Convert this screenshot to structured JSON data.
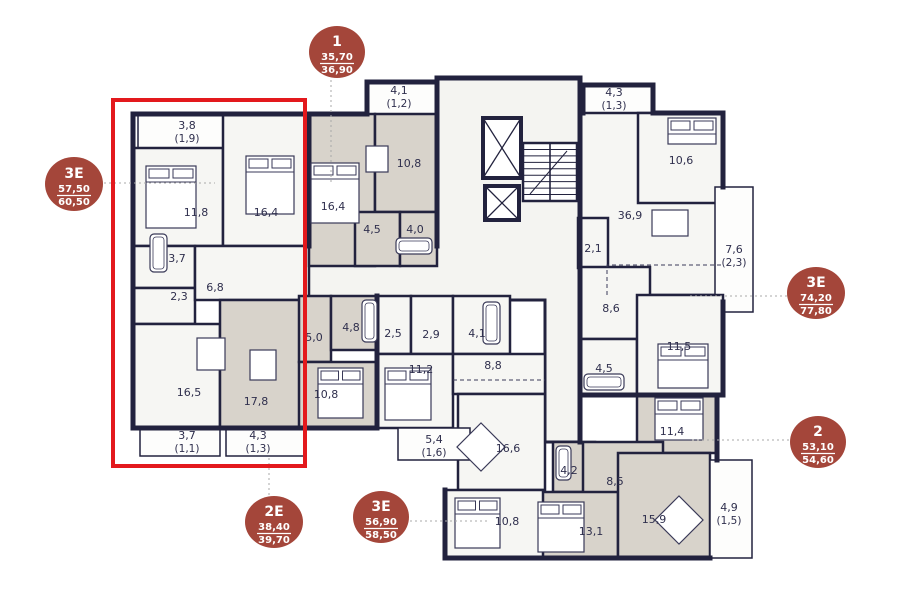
{
  "canvas": {
    "w": 897,
    "h": 616
  },
  "colors": {
    "background": "#ffffff",
    "wall": "#22223e",
    "room_white": "#f6f6f3",
    "room_grey": "#d8d3cb",
    "balcony": "#fdfdfc",
    "corridor": "#f4f4f1",
    "label": "#2f2f4d",
    "badge": "#a4463a",
    "badge_text": "#ffffff",
    "highlight": "#e3191d",
    "leader": "#a9a9a9",
    "furniture": "#3a3a58"
  },
  "badges": [
    {
      "name": "apt-1",
      "label": "1",
      "area": "35,70",
      "total": "36,90",
      "cx": 337,
      "cy": 52,
      "rx": 28,
      "ry": 26,
      "leader": [
        [
          331,
          80
        ],
        [
          331,
          183
        ]
      ]
    },
    {
      "name": "apt-3e-left",
      "label": "3E",
      "area": "57,50",
      "total": "60,50",
      "cx": 74,
      "cy": 184,
      "rx": 29,
      "ry": 27,
      "leader": [
        [
          104,
          183
        ],
        [
          215,
          183
        ]
      ]
    },
    {
      "name": "apt-3e-right",
      "label": "3E",
      "area": "74,20",
      "total": "77,80",
      "cx": 816,
      "cy": 293,
      "rx": 29,
      "ry": 26,
      "leader": [
        [
          690,
          296
        ],
        [
          787,
          296
        ]
      ]
    },
    {
      "name": "apt-2",
      "label": "2",
      "area": "53,10",
      "total": "54,60",
      "cx": 818,
      "cy": 442,
      "rx": 28,
      "ry": 26,
      "leader": [
        [
          692,
          440
        ],
        [
          789,
          440
        ]
      ]
    },
    {
      "name": "apt-2e",
      "label": "2E",
      "area": "38,40",
      "total": "39,70",
      "cx": 274,
      "cy": 522,
      "rx": 29,
      "ry": 26,
      "leader": [
        [
          269,
          458
        ],
        [
          269,
          495
        ]
      ]
    },
    {
      "name": "apt-3e-bottom",
      "label": "3E",
      "area": "56,90",
      "total": "58,50",
      "cx": 381,
      "cy": 517,
      "rx": 28,
      "ry": 26,
      "leader": [
        [
          410,
          521
        ],
        [
          487,
          521
        ]
      ]
    }
  ],
  "highlight": {
    "x": 113,
    "y": 100,
    "w": 192,
    "h": 366
  },
  "corridor": {
    "points": "437,78 580,78 580,442 545,442 545,300 305,300 305,246 437,246"
  },
  "apartments": [
    {
      "name": "apt-3e-left",
      "fill": "white",
      "rooms": [
        {
          "label": "3,8",
          "sub": "(1,9)",
          "x": 138,
          "y": 114,
          "w": 92,
          "h": 34,
          "lx": 187,
          "ly": 125,
          "balcony": true
        },
        {
          "label": "11,8",
          "x": 133,
          "y": 148,
          "w": 90,
          "h": 98,
          "lx": 196,
          "ly": 212
        },
        {
          "label": "16,4",
          "x": 223,
          "y": 114,
          "w": 86,
          "h": 132,
          "lx": 266,
          "ly": 212
        },
        {
          "label": "3,7",
          "x": 133,
          "y": 246,
          "w": 62,
          "h": 42,
          "lx": 177,
          "ly": 258
        },
        {
          "label": "2,3",
          "x": 133,
          "y": 288,
          "w": 62,
          "h": 36,
          "lx": 179,
          "ly": 296
        },
        {
          "label": "6,8",
          "x": 195,
          "y": 246,
          "w": 114,
          "h": 54,
          "lx": 215,
          "ly": 287
        },
        {
          "label": "16,5",
          "x": 133,
          "y": 324,
          "w": 87,
          "h": 104,
          "lx": 189,
          "ly": 392
        },
        {
          "label": "3,7",
          "sub": "(1,1)",
          "x": 140,
          "y": 428,
          "w": 80,
          "h": 28,
          "lx": 187,
          "ly": 435,
          "balcony": true
        }
      ]
    },
    {
      "name": "apt-2e",
      "fill": "grey",
      "rooms": [
        {
          "label": "17,8",
          "x": 220,
          "y": 300,
          "w": 85,
          "h": 128,
          "lx": 256,
          "ly": 401
        },
        {
          "label": "5,0",
          "x": 299,
          "y": 296,
          "w": 32,
          "h": 66,
          "lx": 314,
          "ly": 337
        },
        {
          "label": "4,8",
          "x": 331,
          "y": 296,
          "w": 46,
          "h": 54,
          "lx": 351,
          "ly": 327
        },
        {
          "label": "10,8",
          "x": 299,
          "y": 362,
          "w": 78,
          "h": 66,
          "lx": 326,
          "ly": 394
        },
        {
          "label": "4,3",
          "sub": "(1,3)",
          "x": 226,
          "y": 428,
          "w": 78,
          "h": 28,
          "lx": 258,
          "ly": 435,
          "balcony": true
        }
      ]
    },
    {
      "name": "apt-1",
      "fill": "grey",
      "rooms": [
        {
          "label": "4,1",
          "sub": "(1,2)",
          "x": 367,
          "y": 82,
          "w": 70,
          "h": 32,
          "lx": 399,
          "ly": 90,
          "balcony": true
        },
        {
          "label": "16,4",
          "x": 309,
          "y": 114,
          "w": 66,
          "h": 152,
          "lx": 333,
          "ly": 206
        },
        {
          "label": "10,8",
          "x": 375,
          "y": 114,
          "w": 62,
          "h": 98,
          "lx": 409,
          "ly": 163
        },
        {
          "label": "4,5",
          "x": 355,
          "y": 212,
          "w": 45,
          "h": 54,
          "lx": 372,
          "ly": 229
        },
        {
          "label": "4,0",
          "x": 400,
          "y": 212,
          "w": 37,
          "h": 54,
          "lx": 415,
          "ly": 229
        }
      ]
    },
    {
      "name": "apt-3e-top-right",
      "fill": "white",
      "rooms": [
        {
          "label": "4,3",
          "sub": "(1,3)",
          "x": 583,
          "y": 85,
          "w": 70,
          "h": 28,
          "lx": 614,
          "ly": 92,
          "balcony": true
        },
        {
          "label": "36,9",
          "x": 580,
          "y": 113,
          "w": 143,
          "h": 182,
          "lx": 630,
          "ly": 215
        },
        {
          "label": "10,6",
          "x": 638,
          "y": 113,
          "w": 85,
          "h": 90,
          "lx": 681,
          "ly": 160
        },
        {
          "label": "2,1",
          "x": 578,
          "y": 218,
          "w": 30,
          "h": 50,
          "lx": 593,
          "ly": 248
        },
        {
          "label": "7,6",
          "sub": "(2,3)",
          "x": 715,
          "y": 187,
          "w": 38,
          "h": 125,
          "lx": 734,
          "ly": 249,
          "balcony": true
        },
        {
          "label": "8,6",
          "x": 580,
          "y": 267,
          "w": 70,
          "h": 72,
          "lx": 611,
          "ly": 308
        },
        {
          "label": "4,5",
          "x": 580,
          "y": 339,
          "w": 57,
          "h": 56,
          "lx": 604,
          "ly": 368
        },
        {
          "label": "11,5",
          "x": 637,
          "y": 295,
          "w": 86,
          "h": 100,
          "lx": 679,
          "ly": 346
        }
      ]
    },
    {
      "name": "apt-2",
      "fill": "grey",
      "rooms": [
        {
          "label": "11,4",
          "x": 637,
          "y": 395,
          "w": 80,
          "h": 58,
          "lx": 672,
          "ly": 431
        },
        {
          "label": "4,2",
          "x": 553,
          "y": 442,
          "w": 42,
          "h": 50,
          "lx": 569,
          "ly": 470
        },
        {
          "label": "8,5",
          "x": 583,
          "y": 442,
          "w": 80,
          "h": 60,
          "lx": 615,
          "ly": 481
        },
        {
          "label": "13,1",
          "x": 533,
          "y": 492,
          "w": 85,
          "h": 66,
          "lx": 591,
          "ly": 531
        },
        {
          "label": "15,9",
          "x": 618,
          "y": 453,
          "w": 92,
          "h": 105,
          "lx": 654,
          "ly": 519
        },
        {
          "label": "4,9",
          "sub": "(1,5)",
          "x": 710,
          "y": 460,
          "w": 42,
          "h": 98,
          "lx": 729,
          "ly": 507,
          "balcony": true
        }
      ]
    },
    {
      "name": "apt-3e-bottom",
      "fill": "white",
      "rooms": [
        {
          "label": "2,5",
          "x": 377,
          "y": 296,
          "w": 34,
          "h": 58,
          "lx": 393,
          "ly": 333
        },
        {
          "label": "2,9",
          "x": 411,
          "y": 296,
          "w": 42,
          "h": 58,
          "lx": 431,
          "ly": 334
        },
        {
          "label": "4,1",
          "x": 453,
          "y": 296,
          "w": 57,
          "h": 58,
          "lx": 477,
          "ly": 333
        },
        {
          "label": "11,2",
          "x": 377,
          "y": 354,
          "w": 76,
          "h": 74,
          "lx": 421,
          "ly": 369
        },
        {
          "label": "8,8",
          "x": 453,
          "y": 354,
          "w": 92,
          "h": 40,
          "lx": 493,
          "ly": 365
        },
        {
          "label": "16,6",
          "x": 458,
          "y": 394,
          "w": 87,
          "h": 96,
          "lx": 508,
          "ly": 448
        },
        {
          "label": "10,8",
          "x": 445,
          "y": 490,
          "w": 98,
          "h": 68,
          "lx": 507,
          "ly": 521
        },
        {
          "label": "5,4",
          "sub": "(1,6)",
          "x": 398,
          "y": 428,
          "w": 72,
          "h": 32,
          "lx": 434,
          "ly": 439,
          "balcony": true
        }
      ]
    }
  ],
  "walls": [
    [
      133,
      114,
      309,
      114
    ],
    [
      133,
      114,
      133,
      428
    ],
    [
      133,
      428,
      377,
      428
    ],
    [
      309,
      114,
      367,
      114
    ],
    [
      309,
      114,
      309,
      246
    ],
    [
      367,
      82,
      437,
      82
    ],
    [
      367,
      82,
      367,
      114
    ],
    [
      437,
      78,
      437,
      246
    ],
    [
      437,
      78,
      580,
      78
    ],
    [
      580,
      78,
      580,
      442
    ],
    [
      583,
      85,
      653,
      85
    ],
    [
      583,
      85,
      583,
      113
    ],
    [
      653,
      85,
      653,
      113
    ],
    [
      653,
      113,
      723,
      113
    ],
    [
      723,
      113,
      723,
      187
    ],
    [
      723,
      302,
      723,
      395
    ],
    [
      580,
      395,
      723,
      395
    ],
    [
      717,
      395,
      717,
      460
    ],
    [
      445,
      558,
      710,
      558
    ],
    [
      445,
      490,
      445,
      558
    ],
    [
      377,
      296,
      377,
      428
    ]
  ],
  "dashed": [
    [
      [
        607,
        295
      ],
      [
        607,
        265
      ],
      [
        723,
        265
      ]
    ],
    [
      [
        453,
        380
      ],
      [
        545,
        380
      ]
    ]
  ],
  "core": {
    "elevators": [
      {
        "x": 483,
        "y": 118,
        "w": 38,
        "h": 60
      },
      {
        "x": 485,
        "y": 186,
        "w": 34,
        "h": 34
      }
    ],
    "stairs": {
      "x": 523,
      "y": 143,
      "w": 54,
      "h": 58,
      "steps": 9
    }
  },
  "furniture": [
    {
      "type": "bed",
      "x": 146,
      "y": 166,
      "w": 50,
      "h": 62
    },
    {
      "type": "bed",
      "x": 246,
      "y": 156,
      "w": 48,
      "h": 58
    },
    {
      "type": "bed",
      "x": 311,
      "y": 163,
      "w": 48,
      "h": 60
    },
    {
      "type": "bed",
      "x": 318,
      "y": 368,
      "w": 45,
      "h": 50
    },
    {
      "type": "bed",
      "x": 385,
      "y": 368,
      "w": 46,
      "h": 52
    },
    {
      "type": "bed",
      "x": 455,
      "y": 498,
      "w": 45,
      "h": 50
    },
    {
      "type": "bed",
      "x": 538,
      "y": 502,
      "w": 46,
      "h": 50
    },
    {
      "type": "bed",
      "x": 658,
      "y": 344,
      "w": 50,
      "h": 44
    },
    {
      "type": "bed",
      "x": 655,
      "y": 398,
      "w": 48,
      "h": 42
    },
    {
      "type": "bed",
      "x": 668,
      "y": 118,
      "w": 48,
      "h": 26
    },
    {
      "type": "table",
      "x": 197,
      "y": 338,
      "w": 28,
      "h": 32
    },
    {
      "type": "table",
      "x": 250,
      "y": 350,
      "w": 26,
      "h": 30
    },
    {
      "type": "table",
      "x": 652,
      "y": 210,
      "w": 36,
      "h": 26
    },
    {
      "type": "table",
      "x": 366,
      "y": 146,
      "w": 22,
      "h": 26
    },
    {
      "type": "diamond",
      "cx": 481,
      "cy": 447,
      "r": 17
    },
    {
      "type": "diamond",
      "cx": 679,
      "cy": 520,
      "r": 17
    },
    {
      "type": "tub",
      "x": 150,
      "y": 234,
      "w": 17,
      "h": 38
    },
    {
      "type": "tub",
      "x": 396,
      "y": 238,
      "w": 36,
      "h": 16
    },
    {
      "type": "tub",
      "x": 584,
      "y": 374,
      "w": 40,
      "h": 16
    },
    {
      "type": "tub",
      "x": 483,
      "y": 302,
      "w": 17,
      "h": 42
    },
    {
      "type": "tub",
      "x": 556,
      "y": 446,
      "w": 15,
      "h": 34
    },
    {
      "type": "tub",
      "x": 362,
      "y": 300,
      "w": 15,
      "h": 42
    }
  ]
}
